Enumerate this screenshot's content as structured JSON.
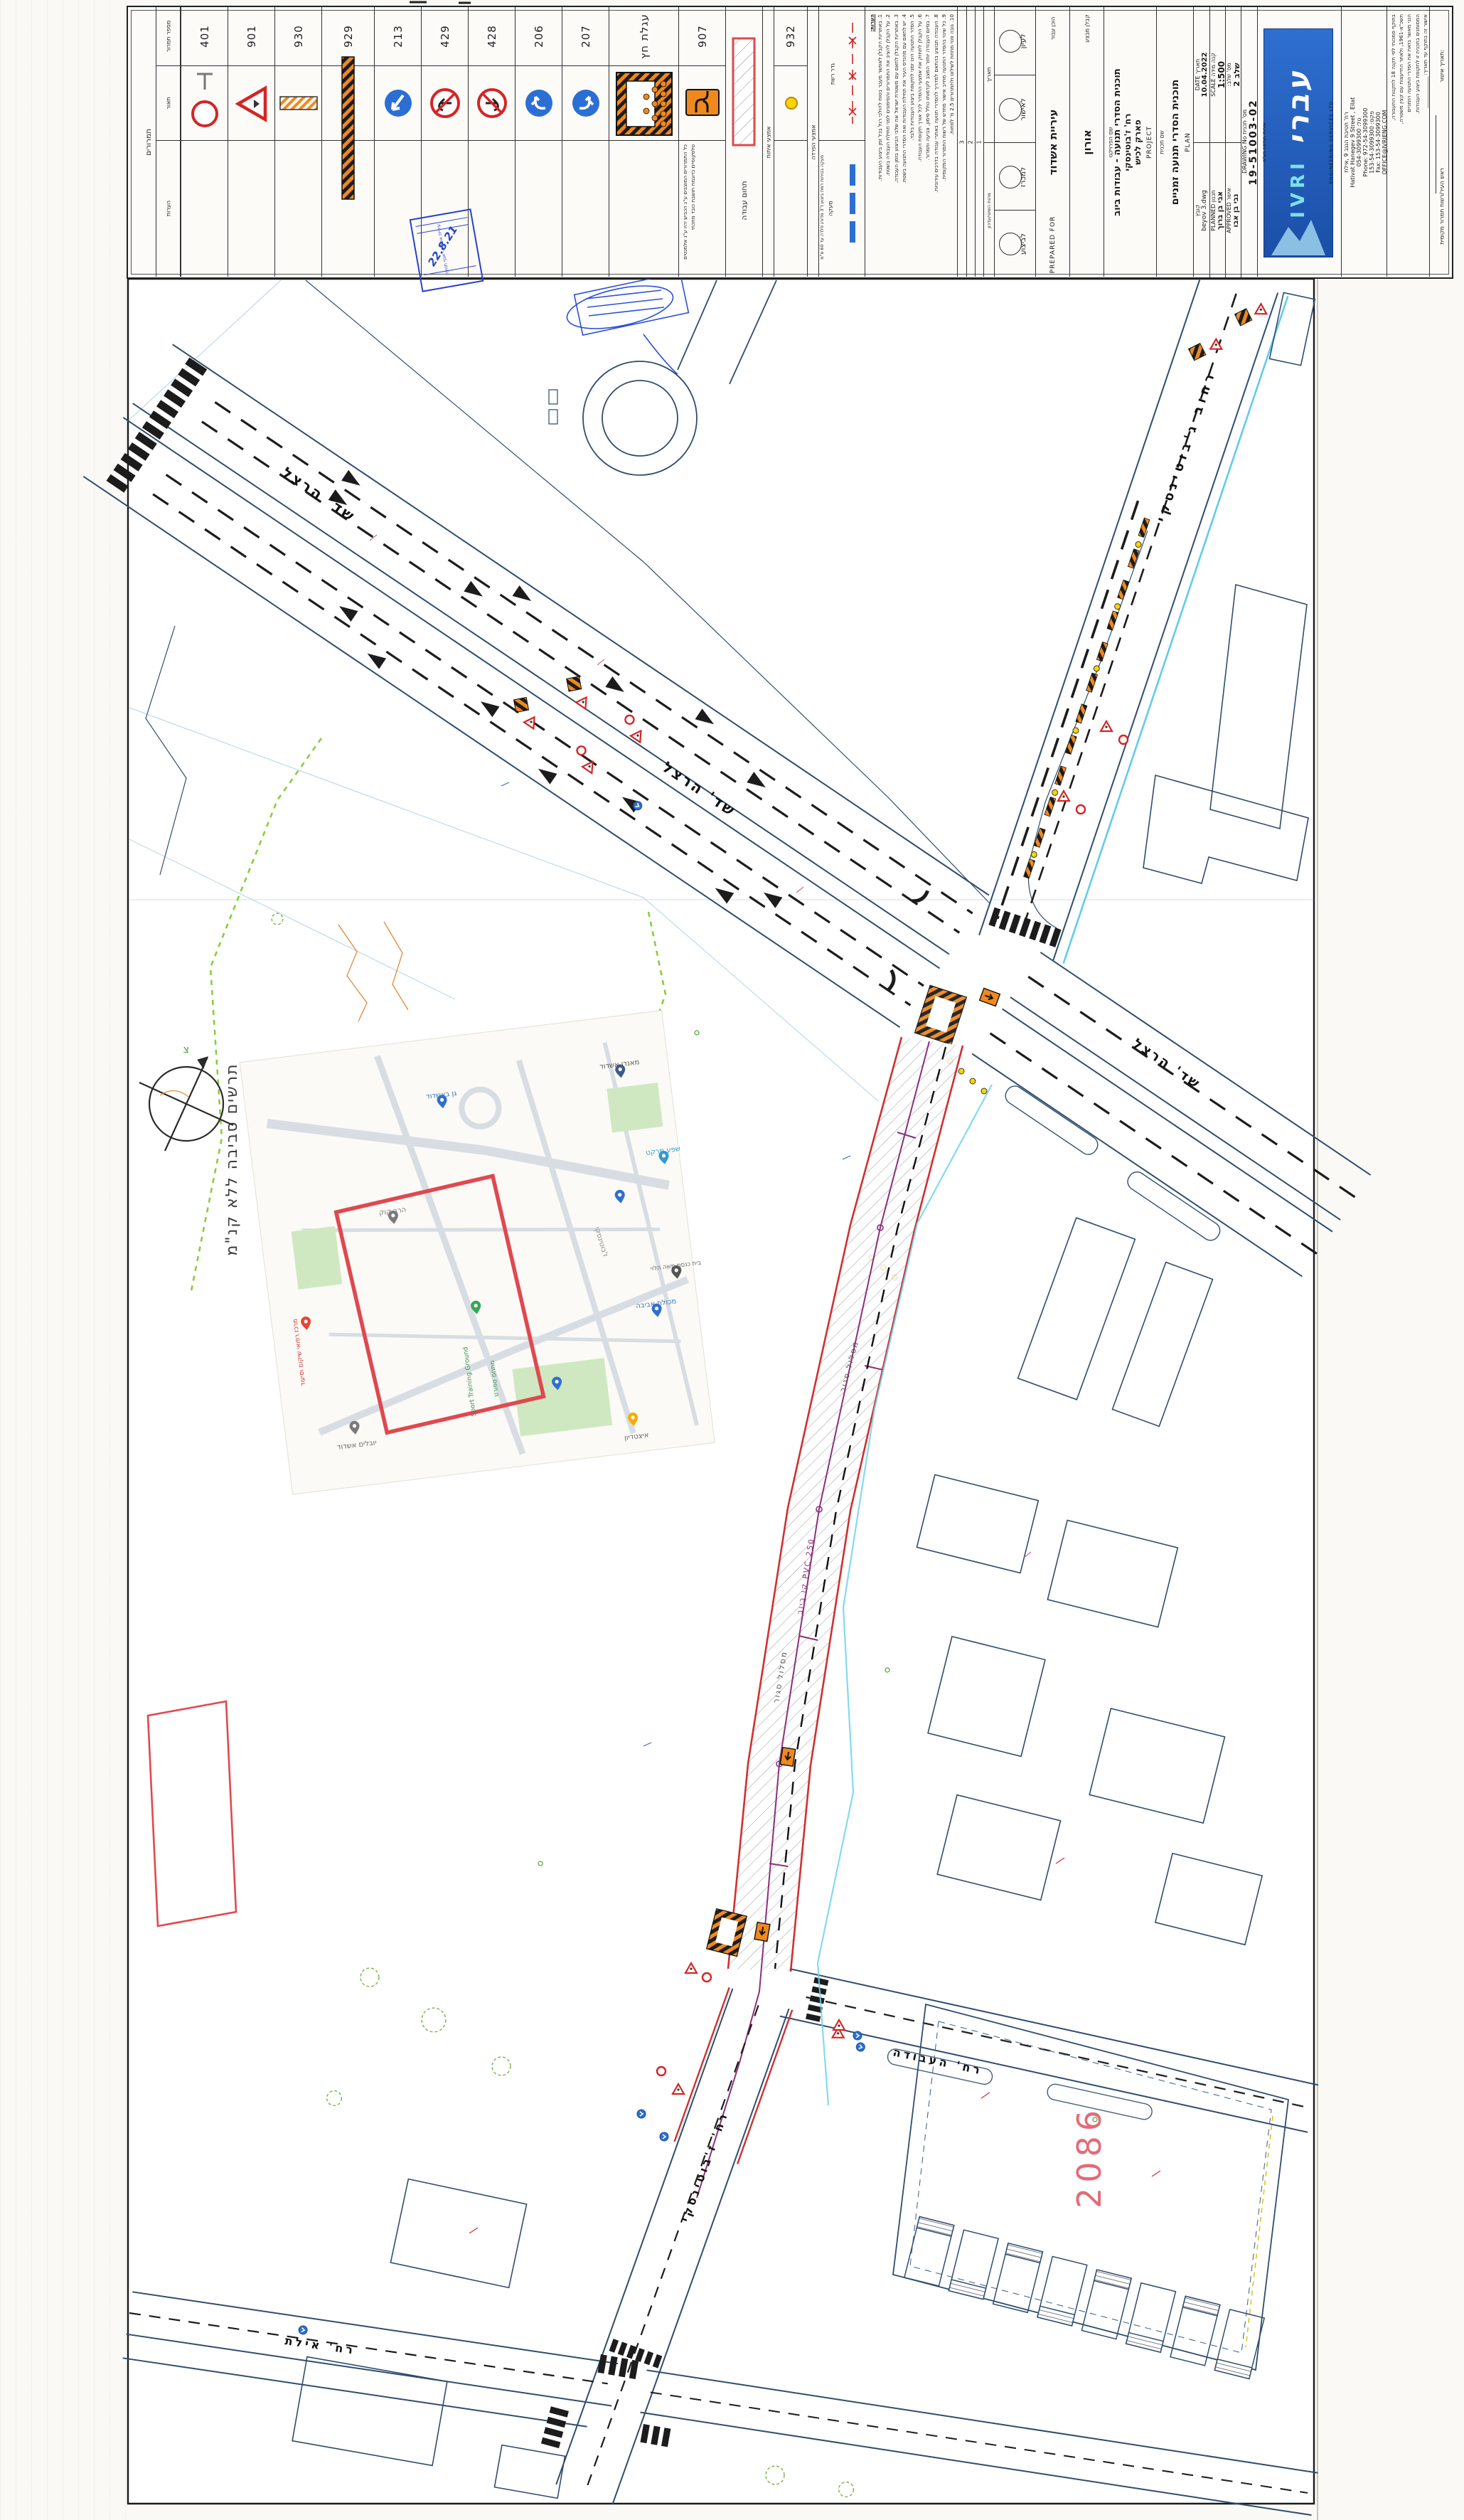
{
  "title_block": {
    "signs_section": {
      "section_title": "תמרורים",
      "header_number": "מספר תמרור",
      "header_drawing": "תאור",
      "header_notes": "הערות",
      "signs": [
        {
          "num": "401"
        },
        {
          "num": "901"
        },
        {
          "num": "930"
        },
        {
          "num": "929"
        },
        {
          "num": "213"
        },
        {
          "num": "429"
        },
        {
          "num": "428"
        },
        {
          "num": "206"
        },
        {
          "num": "207"
        },
        {
          "num": "עגלת חץ"
        },
        {
          "num": "907"
        }
      ],
      "signs_note": "כל התמרורים המוצבים ע\"ג הכביש יהיו ע\"ג אלמנטים טלסקופיים כדוגמת תושבת כובד מתכתי"
    },
    "work_area_label": "תחום עבודה",
    "signaling": {
      "title": "אמצעי איתות",
      "num": "932"
    },
    "separation": {
      "title": "אמצעי הפרדה",
      "fence_label": "גדר רשת",
      "rail_label": "מעקה",
      "rail_note": "מעקה בטיחות רמת ביצוע ד'3 מדורג פלדה עד 60 ס\"מ"
    },
    "notes": {
      "title": "הערות:",
      "lines": [
        "1. באחריות הקבלן לאפשר מעבר בטוח להולכי רגל בכל זמן ביצוע העבודות.",
        "2. על הקבלן להציב את התמרורים והסימונים לפני תחילת העבודה בשטח.",
        "3. באחריות הקבלן לתאם עם משטרת ישראל את שלבי הביצוע בזמן העבודה.",
        "4. יש לתאם עם מהנדס העיר את תחילת העבודות ואת הסדרי התנועה בשטח.",
        "5. הסדר התנועה הינו זמני לתקופת ביצוע העבודות בלבד.",
        "6. על הקבלן לתחזק את אמצעי ההסדר לכל אורך תקופת העבודה.",
        "7. בסיום העבודה יוחזר המצב לקדמותו כולל סימון, צביעה ותמרור.",
        "8. העבודה תבוצע בהתאם למדריך להסדרי תנועה באתרי עבודה בדרכים עירוניות.",
        "9. כל שינוי בהסדר התנועה מחייב אישור מחדש של רשות התמרור המקומית.",
        "10. גובה פנוי מתחת לשילוט ולתמרורים 2.5 מ' לפחות."
      ]
    },
    "revisions": {
      "header_date": "תאריך",
      "header_change": "מהות השינוי/עדכון",
      "rows": [
        "3",
        "2",
        "1"
      ]
    },
    "approvals": [
      "לעיון",
      "לאישור",
      "למכרז",
      "לביצוע"
    ],
    "prepared_for": {
      "label_he": "הוכן עבור",
      "client": "עיריית אשדוד",
      "label_en": "PREPARED FOR"
    },
    "contractor": {
      "label": "קבלן מבצע",
      "name": "אורון"
    },
    "project": {
      "label_he": "שם הפרויקט",
      "line1": "תוכנית הסדרי תנועה - עבודות ביוב",
      "line2": "רח' ז'בוטינסקי",
      "line3": "פארק לכיש",
      "label_en": "PROJECT"
    },
    "plan": {
      "label_he": "שם תכנית",
      "name": "תוכנית הסדרי תנועה זמניים",
      "label_en": "PLAN"
    },
    "info": {
      "date_label": "תאריך DATE",
      "date": "10.04.2022",
      "file_label": "קובץ",
      "file": "beyov 3.dwg",
      "scale_label": "קנה מידה SCALE",
      "scale": "1:500",
      "planned_label": "תכנון PLANNED",
      "planner": "אבי בן ברוך",
      "stage_label": "מס' שלב:",
      "stage": "שלב 2",
      "approved_label": "אישר APPROVED",
      "approver": "נבי בן אבו",
      "drawing_label": "מס' תכנית DRAWING No.",
      "drawing_no": "19-51003-02"
    },
    "firm": {
      "logo_he": "עברי",
      "logo_en": "IVRI",
      "logo_sub": "ENGINEERING SERVICES LTD",
      "logo_sub_he": "שירותי הנדסה בע\"מ",
      "addr_he": "רח' חטיבת הנגב 9 ,אילת",
      "addr_en": "Hativat Hanegev 9 Street , Eilat",
      "phone_he": "טל: 054-3099300",
      "phone_en": "Phone: 972-54-3099300",
      "fax_he": "פקס: 153-54-3099300",
      "fax_en": "Fax: 153-54-3099300",
      "email_he": "דוא\"ל:",
      "email": "OFFICE@IVRIENG.COM"
    },
    "legal": {
      "lines": [
        "בתוקף סמכותי לפי תקנה 18 לתקנות התעבורה,",
        "תשכ\"א-1961, ולאחר התייעצות עם קצין משטרה,",
        "הנני מאשר בזאת את הסדרי התנועה הזמניים",
        "המסומנים בתכנית זו לתקופת ביצוע העבודות.",
        "אישור זה בתוקף עד תאריך: ____________"
      ],
      "approval_date_label": "תאריך אישור:",
      "authority": "ראש העיר/רשות תמרור מקומית"
    },
    "stamp": {
      "date": "22.8.21",
      "line1": "עיריית אשדוד - אגף תנועה",
      "line2": "התקבל"
    }
  },
  "map": {
    "streets": {
      "herzl": "שד' הרצל",
      "jabotinsky_full": "רחוב ג'בוטינסקי",
      "jabotinsky": "רח' ז'בוטינסקי",
      "haavoda": "רח' העבודה",
      "eilat": "רח' אילת"
    },
    "labels": {
      "parcel": "2086",
      "closed_route": "מסלול סגור",
      "sewer": "קו ביוב PVC 250",
      "inset_title": "תרשים סביבה ללא קנ\"מ",
      "north": "צ"
    },
    "inset_places": {
      "p1": "גן באשדוד",
      "p2": "מאנדו אשדוד",
      "p3": "שפע מרקט",
      "p4": "הרב קוק",
      "p5": "ז'בוטינסקי",
      "p6": "מכולת אביבה",
      "p7": "בית כנסת משה הלוי",
      "p8": "Sport Training Ground",
      "p9": "מתחם ספורט",
      "p10": "יובלים אשדוד",
      "p11": "איצטדיון",
      "p12": "מרכז רפואי שיקום וסיעוד"
    }
  }
}
